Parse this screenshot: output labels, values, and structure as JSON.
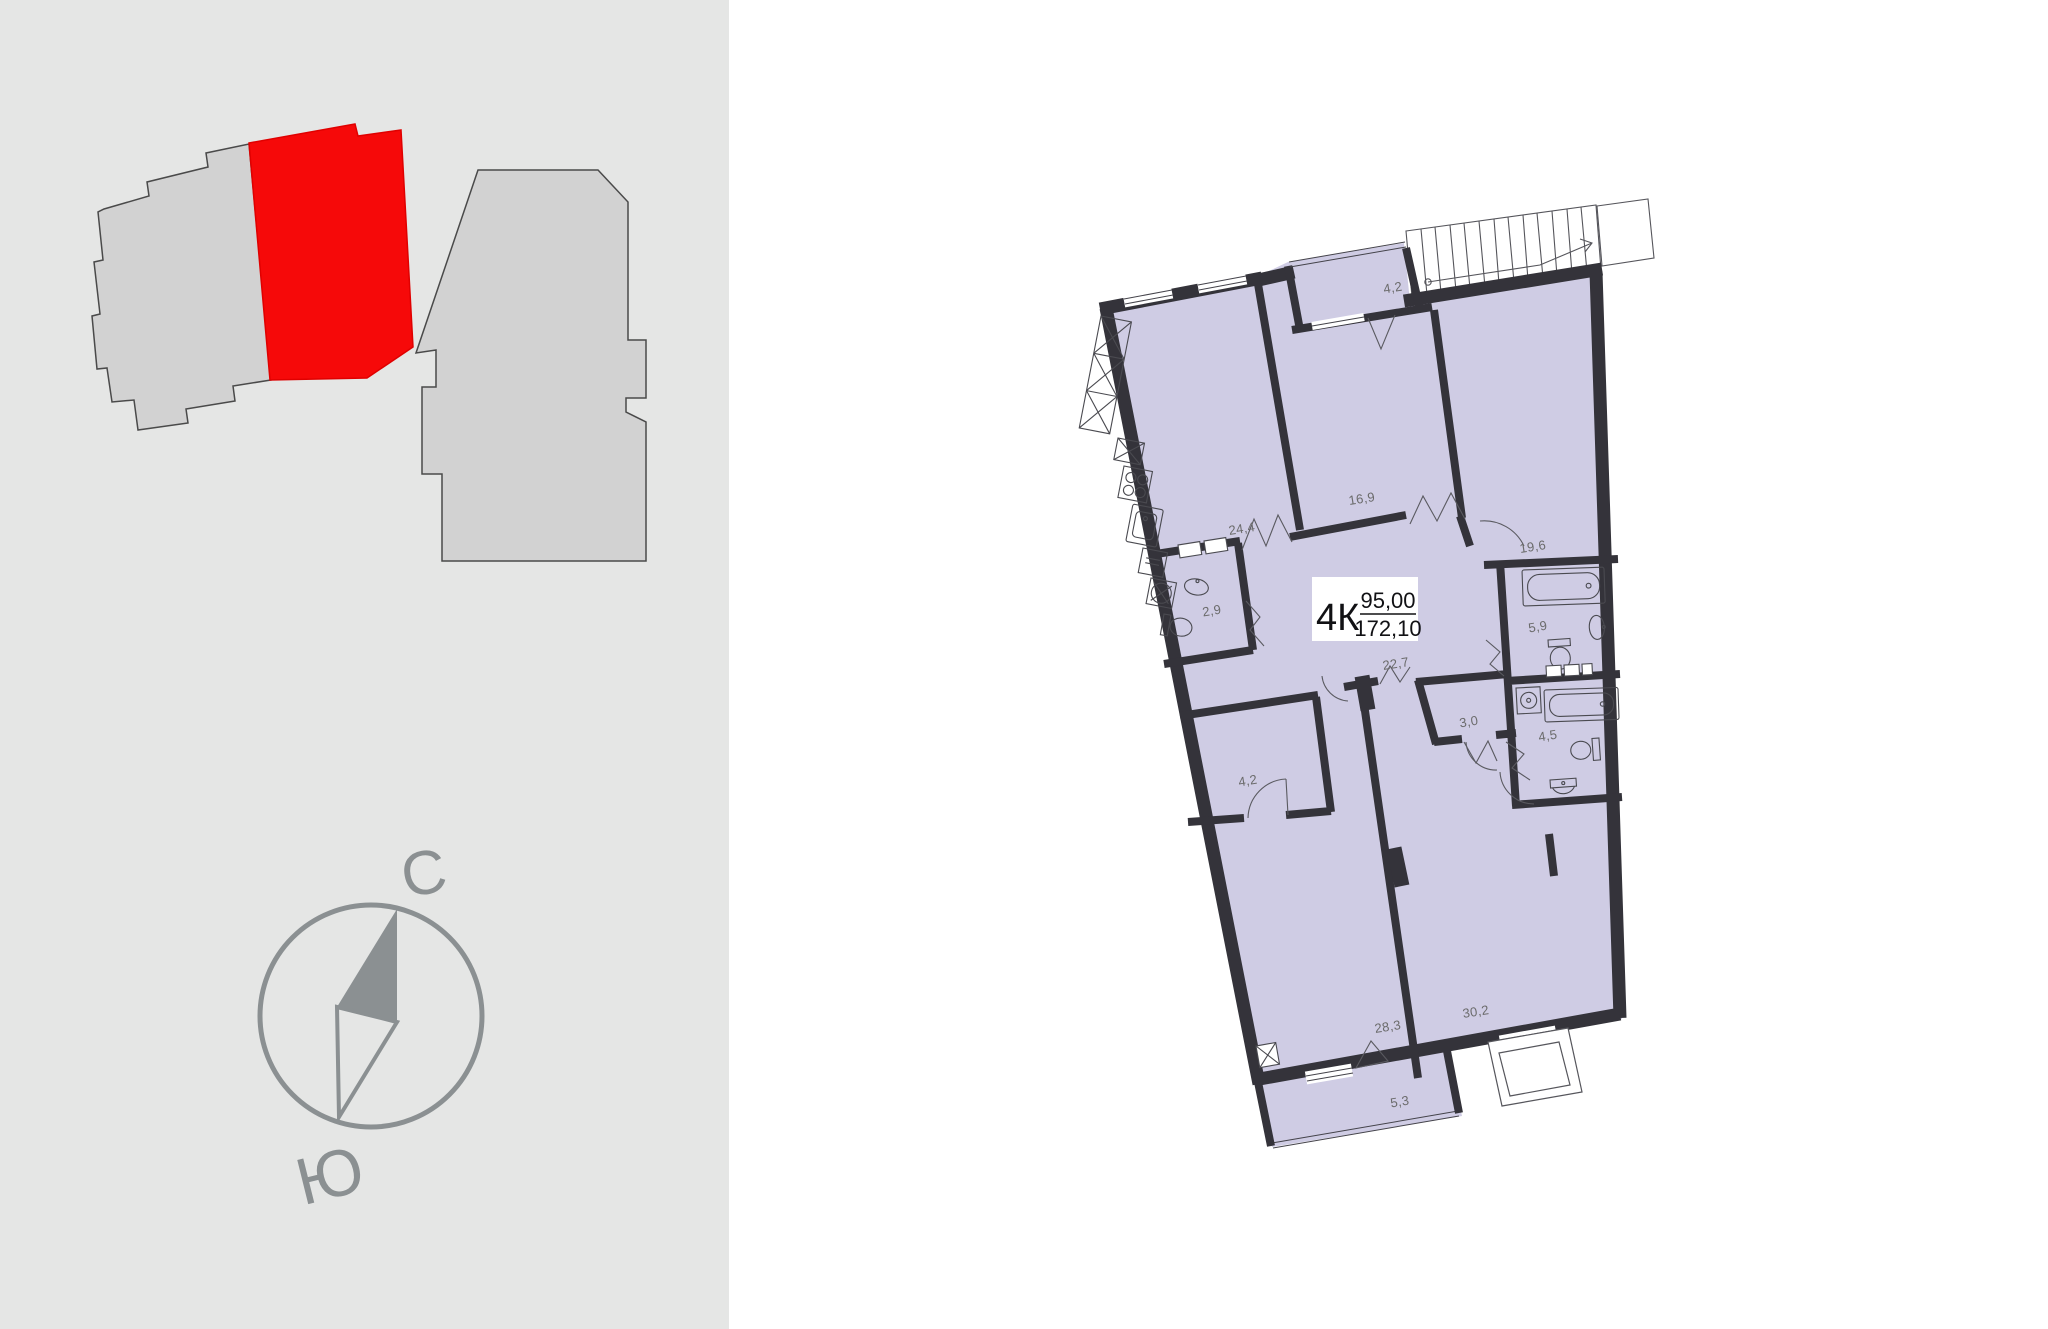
{
  "left_panel": {
    "background": "#e5e6e5"
  },
  "site_plan": {
    "building_fill": "#d2d2d2",
    "building_outline": "#4a4a4a",
    "selected_unit_fill": "#f60909"
  },
  "compass": {
    "north_label": "С",
    "south_label": "Ю",
    "color": "#8b9092"
  },
  "floor_plan": {
    "wall_color": "#34333a",
    "room_fill": "#cfcce4",
    "label_color": "#6b6b6b",
    "unit_badge": {
      "type": "4К",
      "area_living": "95,00",
      "area_total": "172,10"
    },
    "room_areas": [
      {
        "name": "balcony-top",
        "area": "4,2"
      },
      {
        "name": "bedroom-middle",
        "area": "16,9"
      },
      {
        "name": "kitchen-living",
        "area": "24,4"
      },
      {
        "name": "bedroom-right",
        "area": "19,6"
      },
      {
        "name": "wc",
        "area": "2,9"
      },
      {
        "name": "bathroom-upper",
        "area": "5,9"
      },
      {
        "name": "hall",
        "area": "22,7"
      },
      {
        "name": "storage",
        "area": "3,0"
      },
      {
        "name": "bathroom-lower",
        "area": "4,5"
      },
      {
        "name": "wardrobe",
        "area": "4,2"
      },
      {
        "name": "bedroom-bottom-left",
        "area": "28,3"
      },
      {
        "name": "room-bottom-right",
        "area": "30,2"
      },
      {
        "name": "balcony-bottom",
        "area": "5,3"
      }
    ]
  }
}
